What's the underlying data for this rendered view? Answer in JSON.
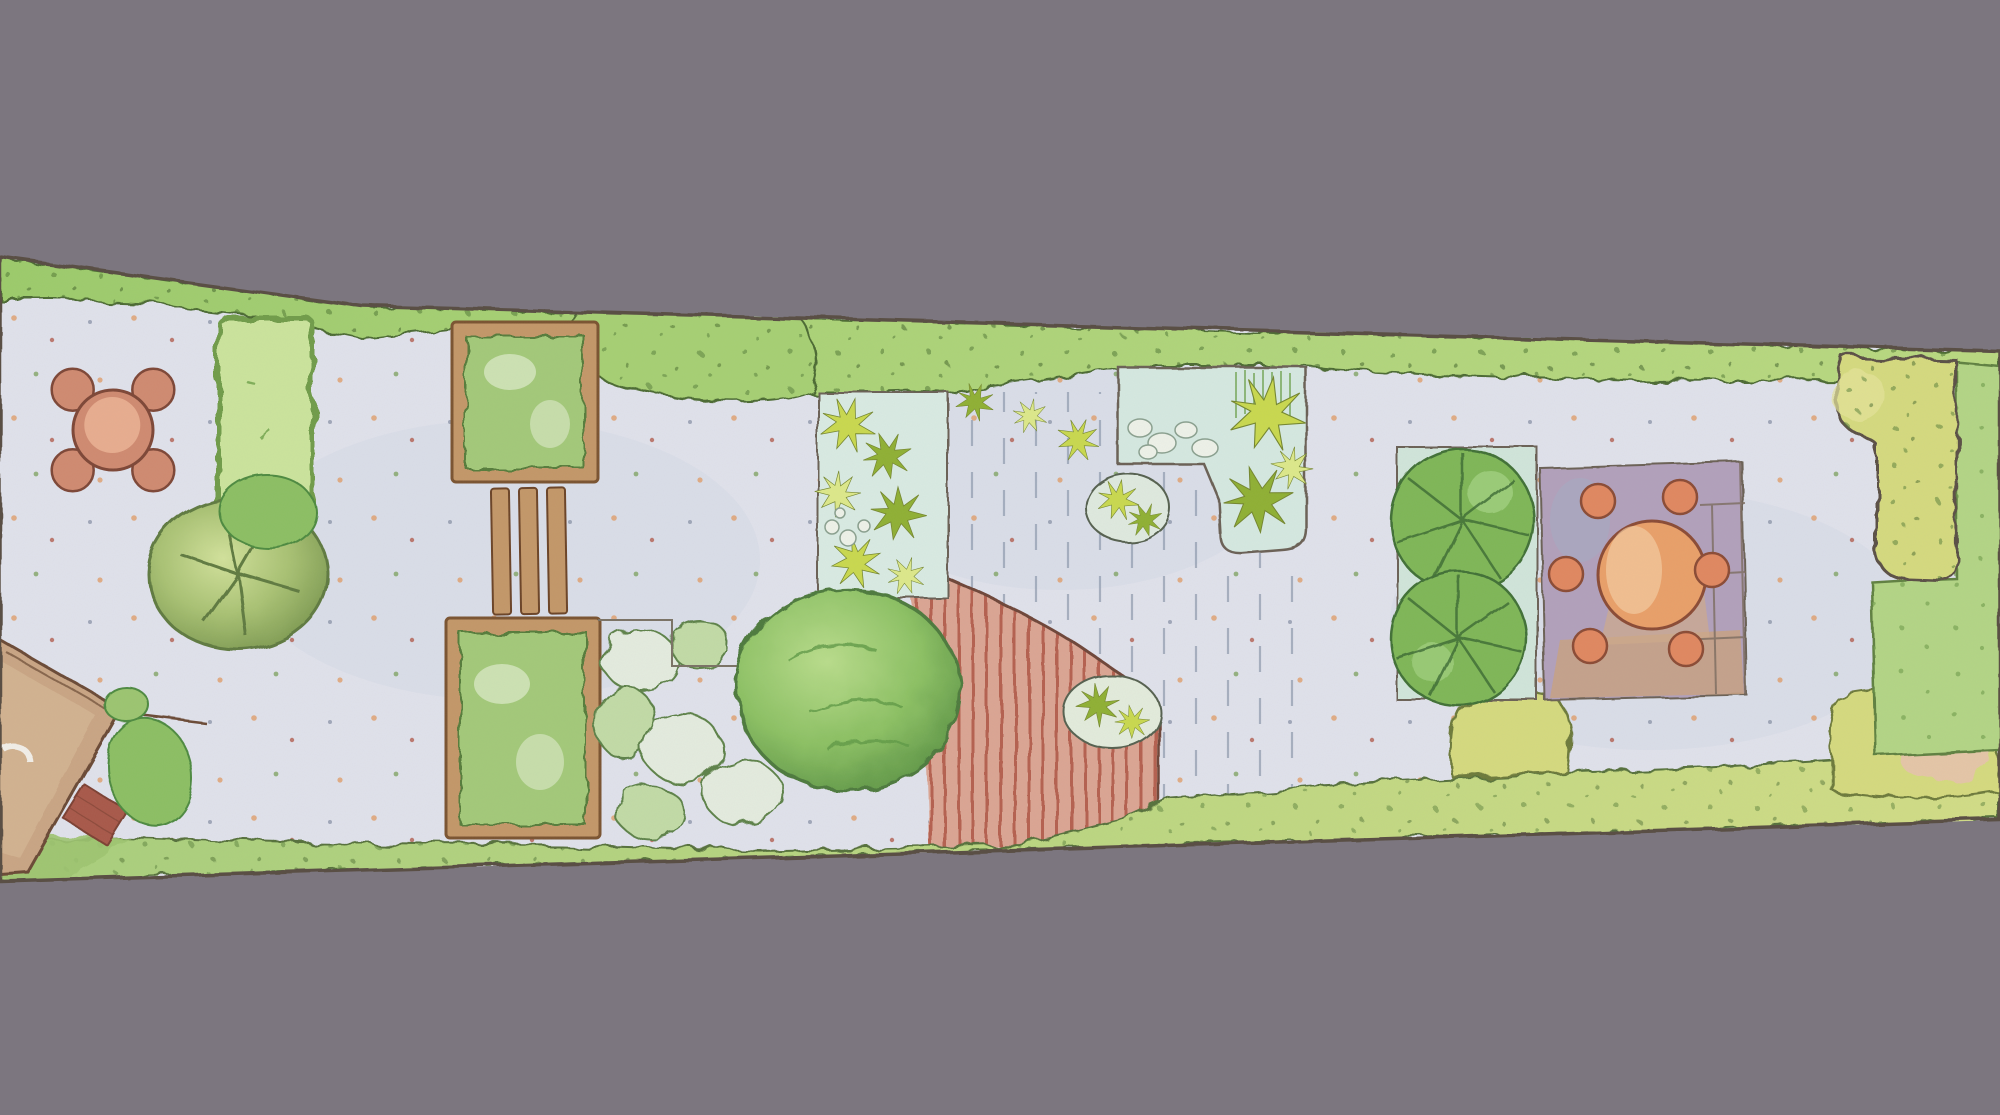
{
  "scene": {
    "description": "Hand-painted overhead garden design plan illustration on a plain grey backdrop",
    "medium": "watercolor and ink, plan view",
    "orientation": "long narrow plot running horizontally, slightly rotated so the strip tapers toward the right"
  },
  "palette": {
    "background": "#7c767f",
    "outline": "#5a5044",
    "paving": "#e0e2ec",
    "paving_wash": "#b9c4da",
    "hedge": "#a6d073",
    "hedge_light": "#c6e489",
    "hedge_dark": "#527a36",
    "hedge_yellow": "#d2dd86",
    "hedge_block": "#cbe49c",
    "lawn": "#b3d585",
    "lawn_dot": "#6f9c4a",
    "shrub_bed_yellow": "#d5da7e",
    "grass_strip": "#9ec56f",
    "tree_dark": "#5f7a3f",
    "big_shrub_edge": "#4e7a3c",
    "wood": "#c39768",
    "wood_dark": "#7a5330",
    "bed_green": "#a3c979",
    "bed_green_light": "#d7e8c2",
    "mound_light": "#e4ecdf",
    "mound_green": "#c2dba6",
    "mound_edge": "#5d8248",
    "star_yellow": "#c9d94e",
    "star_green": "#8fb033",
    "star_pale": "#dde98a",
    "bed_pale": "#d9ebe3",
    "pond": "#d5e9e1",
    "pebble": "#eef2e9",
    "deck_red": "#dba593",
    "deck_red_line": "#b5614f",
    "deck_dash": "#97a2b4",
    "leaf_bed": "#d0e5da",
    "leaf_green": "#7eb657",
    "leaf_light": "#abd98b",
    "leaf_vein": "#36632e",
    "mauve": "#b1a0bb",
    "tan_paver": "#c8a183",
    "table_orange": "#e99f68",
    "table_light": "#f6cfa4",
    "stool": "#e0875f",
    "furniture_edge": "#8a4a34",
    "terracotta": "#d08a70",
    "terracotta_light": "#eab092",
    "house_roof": "#c9a584",
    "house_roof_light": "#d9bb97",
    "house_edge": "#6b4a35",
    "brick": "#a85948",
    "pink_patch": "#e8c0b2"
  },
  "features": [
    {
      "id": "top-boundary-hedge",
      "label": "continuous clipped hedge along the upper boundary"
    },
    {
      "id": "bottom-boundary-hedge",
      "label": "hedge and grass strip along the lower boundary"
    },
    {
      "id": "patio-dining-set",
      "label": "round terracotta table with four chairs on the left patio"
    },
    {
      "id": "hedge-screen",
      "label": "rectangular hedge-enclosed lawn panel dividing the left patio"
    },
    {
      "id": "specimen-tree",
      "label": "round-canopy specimen tree with branch lines"
    },
    {
      "id": "house-corner",
      "label": "corner of the house roof with brick step and wall-side shrubs, lower left"
    },
    {
      "id": "raised-bed-upper",
      "label": "timber-edged square planting bed, upper"
    },
    {
      "id": "timber-steps",
      "label": "three timber boards between the two square beds"
    },
    {
      "id": "raised-bed-lower",
      "label": "timber-edged square planting bed, lower"
    },
    {
      "id": "mixed-shrub-mounds",
      "label": "low mounded shrub planting beside the lower bed"
    },
    {
      "id": "clipped-ball-shrub",
      "label": "large clipped ball shrub at the centre of the plot"
    },
    {
      "id": "perennial-star-bed",
      "label": "narrow bed of star-leaved perennials with pebbles"
    },
    {
      "id": "pale-deck",
      "label": "pale timber deck drawn with vertical board dashes"
    },
    {
      "id": "red-deck",
      "label": "red-stained deck with curved edge and board stripes"
    },
    {
      "id": "deck-grass-pockets",
      "label": "ornamental grass pockets set into the decking"
    },
    {
      "id": "pebble-grass-bed",
      "label": "pebble and ornamental grass bed with reeds, mid-right"
    },
    {
      "id": "fig-leaf-bed",
      "label": "bed holding two large-leaved fig-type shrubs"
    },
    {
      "id": "dining-terrace",
      "label": "paved terrace with round orange table and six stools"
    },
    {
      "id": "rear-shrub-bed",
      "label": "yellow-green shrub bed at the rear corner"
    },
    {
      "id": "rear-lawn",
      "label": "rear lawn panel at the far right end"
    },
    {
      "id": "paving-field",
      "label": "pale paving speckled with fallen leaves throughout"
    }
  ]
}
